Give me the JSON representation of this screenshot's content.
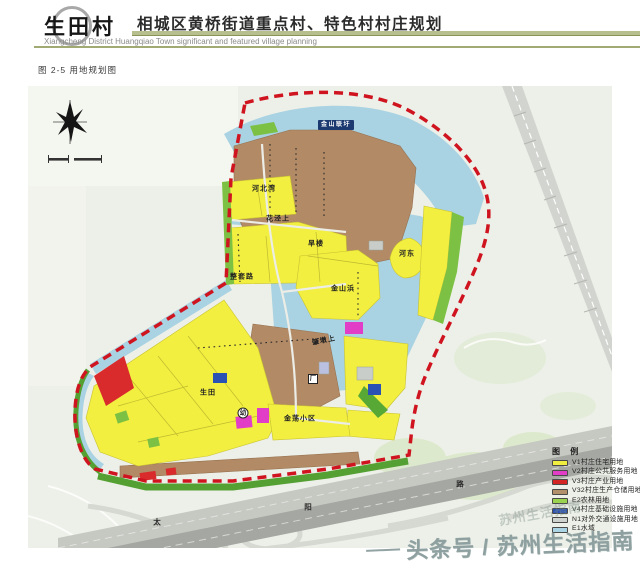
{
  "header": {
    "logo_text": "生田村",
    "title": "相城区黄桥街道重点村、特色村村庄规划",
    "subtitle_en": "Xiangcheng District Huangqiao Town significant and featured village planning"
  },
  "figure_label": "图 2-5 用地规划图",
  "map": {
    "compass": "north-arrow",
    "labels": [
      {
        "text": "金山联圩",
        "x": 308,
        "y": 39,
        "kind": "box"
      },
      {
        "text": "河北湾",
        "x": 236,
        "y": 103,
        "kind": "place"
      },
      {
        "text": "花泾上",
        "x": 250,
        "y": 133,
        "kind": "place"
      },
      {
        "text": "旱楼",
        "x": 288,
        "y": 158,
        "kind": "place"
      },
      {
        "text": "河东",
        "x": 379,
        "y": 168,
        "kind": "place"
      },
      {
        "text": "金山浜",
        "x": 315,
        "y": 203,
        "kind": "place"
      },
      {
        "text": "整套路",
        "x": 214,
        "y": 191,
        "kind": "place"
      },
      {
        "text": "肇墩上",
        "x": 296,
        "y": 255,
        "kind": "place",
        "rot": -12
      },
      {
        "text": "生田",
        "x": 180,
        "y": 307,
        "kind": "place"
      },
      {
        "text": "金荡小区",
        "x": 272,
        "y": 333,
        "kind": "place"
      },
      {
        "text": "幼",
        "x": 215,
        "y": 327,
        "kind": "badge-circle"
      },
      {
        "text": "厂",
        "x": 285,
        "y": 293,
        "kind": "badge-square"
      },
      {
        "text": "太",
        "x": 129,
        "y": 436,
        "kind": "road"
      },
      {
        "text": "阳",
        "x": 280,
        "y": 421,
        "kind": "road"
      },
      {
        "text": "路",
        "x": 432,
        "y": 398,
        "kind": "road"
      }
    ]
  },
  "legend": {
    "title": "图 例",
    "items": [
      {
        "color": "#f0ee3e",
        "label": "V1村庄住宅用地"
      },
      {
        "color": "#e13dc6",
        "label": "V2村庄公共服务用地"
      },
      {
        "color": "#d42525",
        "label": "V3村庄产业用地"
      },
      {
        "color": "#b2906b",
        "label": "V32村庄生产仓储用地"
      },
      {
        "color": "#9ad34f",
        "label": "E2农林用地"
      },
      {
        "color": "#2b50b4",
        "label": "V4村庄基础设施用地"
      },
      {
        "color": "#cfd3cf",
        "label": "N1对外交通设施用地"
      },
      {
        "color": "#aad3e3",
        "label": "E1水域"
      }
    ]
  },
  "watermark": "头条号 / 苏州生活指南",
  "watermark_faint": "苏州生活指南"
}
